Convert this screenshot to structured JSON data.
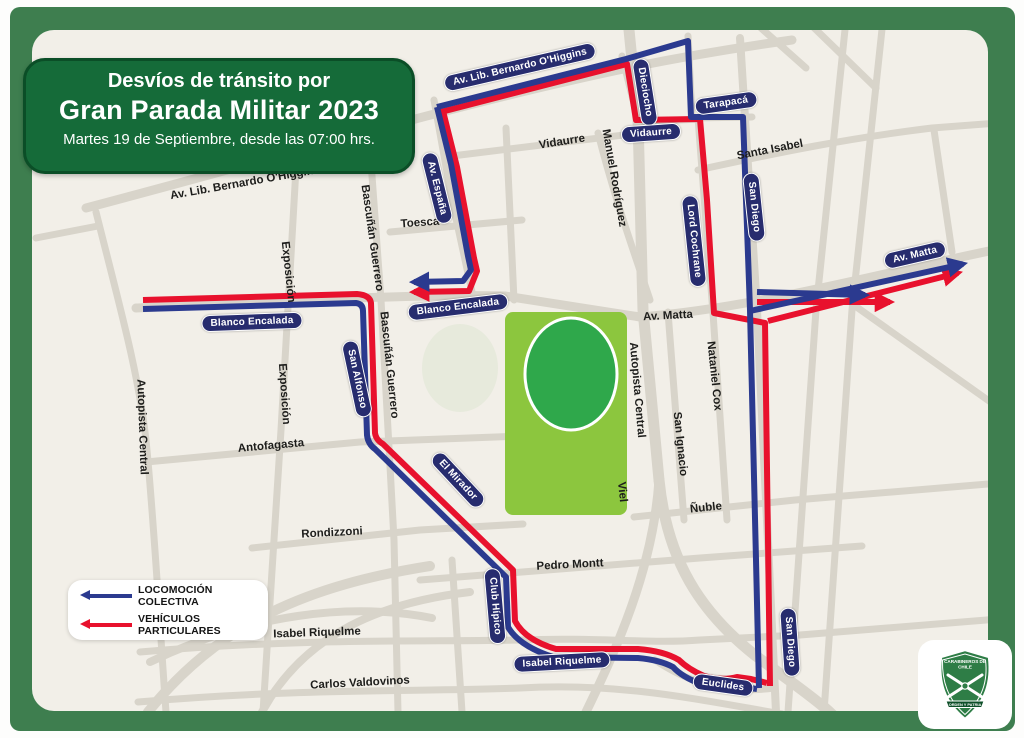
{
  "title": {
    "line1": "Desvíos de tránsito por",
    "line2": "Gran Parada Militar 2023",
    "line3": "Martes 19 de Septiembre, desde las 07:00 hrs."
  },
  "legend": {
    "items": [
      {
        "label": "LOCOMOCIÓN COLECTIVA",
        "color": "#2b3a8f"
      },
      {
        "label": "VEHÍCULOS PARTICULARES",
        "color": "#e8112d"
      }
    ]
  },
  "logo": {
    "top1": "CARABINEROS DE",
    "top2": "CHILE",
    "motto": "ORDEN Y PATRIA"
  },
  "colors": {
    "frame_green": "#3e7e4f",
    "title_green": "#156b39",
    "title_border": "#0b4e27",
    "map_bg": "#f2efe8",
    "street_gray": "#d8d4ca",
    "park_green": "#8cc63e",
    "park_inner_green": "#2fa84b",
    "pill_navy": "#272c6e",
    "route_blue": "#2b3a8f",
    "route_red": "#e8112d",
    "label_dark": "#1d1d1b",
    "shield_green": "#2e7d46"
  },
  "map": {
    "park_label": "Parque O'Higgins",
    "street_pills": [
      {
        "text": "Av. Lib. Bernardo O'Higgins",
        "x": 520,
        "y": 67,
        "rot": -13
      },
      {
        "text": "Dieciocho",
        "x": 645,
        "y": 92,
        "rot": 81
      },
      {
        "text": "Tarapacá",
        "x": 726,
        "y": 103,
        "rot": -8
      },
      {
        "text": "Vidaurre",
        "x": 651,
        "y": 133,
        "rot": -4
      },
      {
        "text": "San Diego",
        "x": 754,
        "y": 207,
        "rot": 84
      },
      {
        "text": "Lord Cochrane",
        "x": 694,
        "y": 241,
        "rot": 84
      },
      {
        "text": "Av. España",
        "x": 437,
        "y": 188,
        "rot": 76
      },
      {
        "text": "Blanco Encalada",
        "x": 252,
        "y": 322,
        "rot": -2
      },
      {
        "text": "Blanco Encalada",
        "x": 458,
        "y": 307,
        "rot": -7
      },
      {
        "text": "San Alfonso",
        "x": 357,
        "y": 379,
        "rot": 78
      },
      {
        "text": "El Mirador",
        "x": 458,
        "y": 480,
        "rot": 47
      },
      {
        "text": "Club Hípico",
        "x": 495,
        "y": 606,
        "rot": 85
      },
      {
        "text": "Isabel Riquelme",
        "x": 562,
        "y": 662,
        "rot": -3
      },
      {
        "text": "Euclides",
        "x": 723,
        "y": 685,
        "rot": 8
      },
      {
        "text": "San Diego",
        "x": 790,
        "y": 642,
        "rot": 86
      },
      {
        "text": "Av. Matta",
        "x": 915,
        "y": 255,
        "rot": -13
      }
    ],
    "street_names": [
      {
        "text": "Av. Lib. Bernardo O'Higgins",
        "x": 245,
        "y": 183,
        "rot": -10
      },
      {
        "text": "Exposición",
        "x": 288,
        "y": 272,
        "rot": 84
      },
      {
        "text": "Bascuñán Guerrero",
        "x": 372,
        "y": 238,
        "rot": 82
      },
      {
        "text": "Toesca",
        "x": 420,
        "y": 223,
        "rot": -4
      },
      {
        "text": "Vidaurre",
        "x": 562,
        "y": 142,
        "rot": -9
      },
      {
        "text": "Manuel Rodríguez",
        "x": 614,
        "y": 178,
        "rot": 80
      },
      {
        "text": "Santa Isabel",
        "x": 770,
        "y": 150,
        "rot": -11
      },
      {
        "text": "Exposición",
        "x": 284,
        "y": 394,
        "rot": 86
      },
      {
        "text": "Bascuñán Guerrero",
        "x": 389,
        "y": 365,
        "rot": 84
      },
      {
        "text": "Autopista Central",
        "x": 142,
        "y": 427,
        "rot": 88
      },
      {
        "text": "Antofagasta",
        "x": 271,
        "y": 446,
        "rot": -5
      },
      {
        "text": "Rondizzoni",
        "x": 332,
        "y": 533,
        "rot": -3
      },
      {
        "text": "Autopista Central",
        "x": 637,
        "y": 390,
        "rot": 85
      },
      {
        "text": "Viel",
        "x": 622,
        "y": 492,
        "rot": 84
      },
      {
        "text": "Nataniel Cox",
        "x": 714,
        "y": 376,
        "rot": 84
      },
      {
        "text": "San Ignacio",
        "x": 680,
        "y": 444,
        "rot": 84
      },
      {
        "text": "Ñuble",
        "x": 706,
        "y": 508,
        "rot": -6
      },
      {
        "text": "Av. Matta",
        "x": 668,
        "y": 316,
        "rot": -3
      },
      {
        "text": "Pedro Montt",
        "x": 570,
        "y": 565,
        "rot": -3
      },
      {
        "text": "Isabel Riquelme",
        "x": 317,
        "y": 633,
        "rot": -2
      },
      {
        "text": "Carlos Valdovinos",
        "x": 360,
        "y": 683,
        "rot": -3
      }
    ]
  }
}
